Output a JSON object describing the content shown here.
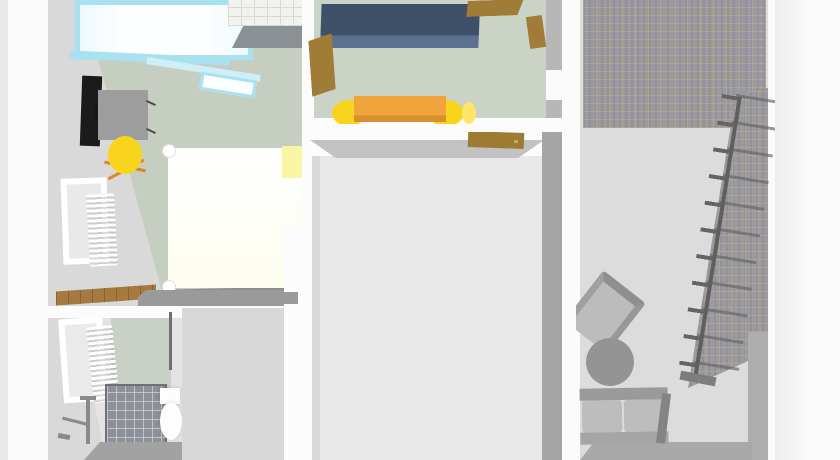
{
  "scene": {
    "description": "3D rendered apartment floor plan, top-down dollhouse view, no visible text labels",
    "rooms": [
      {
        "name": "bedroom",
        "objects": [
          "glazed-balcony",
          "tiled-counter",
          "black-wardrobe-panel",
          "desk",
          "black-desk-chair",
          "yellow-office-chair",
          "double-bed",
          "yellow-nightstand",
          "window",
          "radiator",
          "wood-floor-strip"
        ]
      },
      {
        "name": "kitchen",
        "objects": [
          "blue-kitchen-counter",
          "wooden-cabinet-doors",
          "orange-dining-table",
          "yellow-dining-chairs"
        ]
      },
      {
        "name": "empty-room",
        "objects": [
          "wooden-door"
        ]
      },
      {
        "name": "bathroom",
        "objects": [
          "window",
          "radiator",
          "mosaic-shower-tray",
          "washstand",
          "toilet"
        ]
      },
      {
        "name": "stair-hall",
        "objects": [
          "brick-tiled-floor",
          "staircase",
          "stair-railing",
          "armchair",
          "round-coffee-table",
          "sofa"
        ]
      }
    ]
  },
  "colors": {
    "bg": "#fbfbfb",
    "edge_strip": "#e9e9e9",
    "margin_band": "#ededed",
    "wall_white": "#fcfcfc",
    "wall_light": "#d9d9d9",
    "wall_mid": "#c2c2c2",
    "wall_gray": "#9a9a9a",
    "wall_right": "#a5a5a5",
    "floor_sage": "#c6cdc1",
    "floor_sage_kitchen": "#cbd2c6",
    "floor_pale": "#e8e8e8",
    "floor_hall": "#dcdcdc",
    "floor_bath": "#e3e3e3",
    "glazing_cyan": "#a8e1f0",
    "glazing_cyan2": "#cfeef7",
    "glass_white": "#fdfeff",
    "tile_white": "#f2f2ee",
    "tile_line": "#d8d8d4",
    "panel_gray": "#8b9095",
    "wardrobe_black": "#1b1b1b",
    "desk_gray": "#9d9d9d",
    "leg_dark": "#4a4a4a",
    "chair_yellow": "#f8d51c",
    "chair_yellow2": "#ffe566",
    "chair_leg_orange": "#d9872b",
    "bed_ivory": "#fdfdf0",
    "bed_shadow": "#8f8f8f",
    "nightstand_yellow": "#f8f5a5",
    "wood_floor": "#a5793f",
    "counter_blue": "#3f5069",
    "counter_blue2": "#5d7291",
    "cabinet_brown": "#a07c36",
    "door_brown": "#9d7b33",
    "door_handle": "#c7a94e",
    "table_orange": "#f2a43c",
    "table_orange_dark": "#d88f2f",
    "kitchen_wall_right": "#b7b7b7",
    "sage_panel": "#c9d0c5",
    "wall_edge_dark": "#6f6f6f",
    "mosaic_gray": "#8e9095",
    "mosaic_border": "#70707a",
    "fixture_gray": "#8a8a8a",
    "toilet_white": "#fdfdfd",
    "bath_edge": "#a2a2a2",
    "gray_zone": "#d8d8d8",
    "divider_white": "#fcfcfc",
    "brick_base": "#9b99a1",
    "brick_grout": "#b2a88b",
    "railing_dark": "#5f5f5f",
    "tread_line": "#646464",
    "stair_base": "#7d7d7d",
    "hall_wall": "#adadad",
    "hall_bottom": "#a9a9a9",
    "armchair_seat": "#bcbcbc",
    "armchair_frame": "#8f8f8f",
    "sofa_gray": "#bdbdbd",
    "sofa_back": "#9a9a9a",
    "sofa_front": "#a5a5a5",
    "sofa_arm": "#848484",
    "table_round": "#949494"
  }
}
